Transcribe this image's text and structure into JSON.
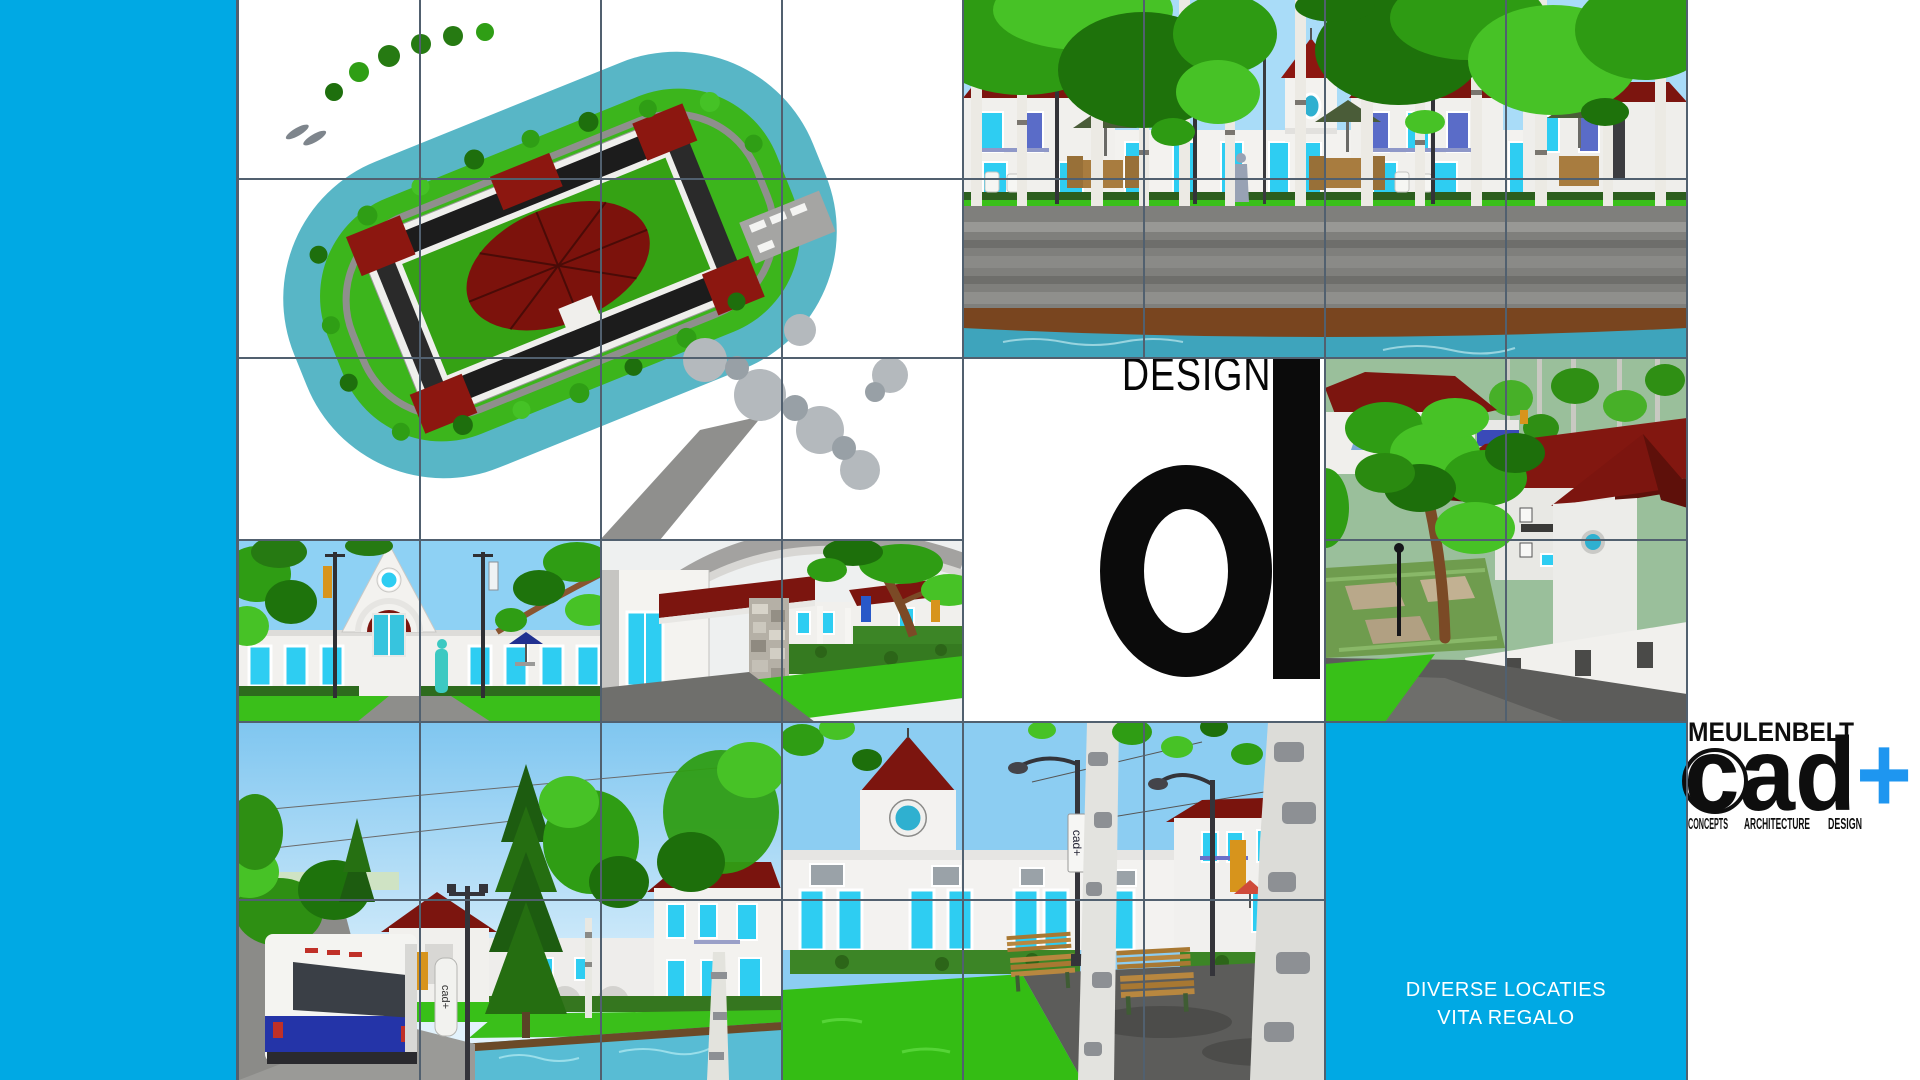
{
  "slide": {
    "design_heading": "DESIGN",
    "location_block": {
      "line1": "DIVERSE LOCATIES",
      "line2": "VITA REGALO"
    },
    "logo": {
      "company": "MEULENBELT",
      "brand": "cad",
      "plus": "+",
      "tagline_1": "CONCEPTS",
      "tagline_2": "ARCHITECTURE",
      "tagline_3": "DESIGN"
    },
    "in_image_labels": {
      "bus_column": "cad+",
      "plaza_banner": "cad+"
    },
    "colors": {
      "accent_cyan": "#00a9e4",
      "logo_plus_blue": "#1e96f0",
      "grid_line": "#51606f",
      "roof_red": "#7c150f",
      "canal_teal": "#58b6c6",
      "lawn_green": "#38c018"
    }
  }
}
